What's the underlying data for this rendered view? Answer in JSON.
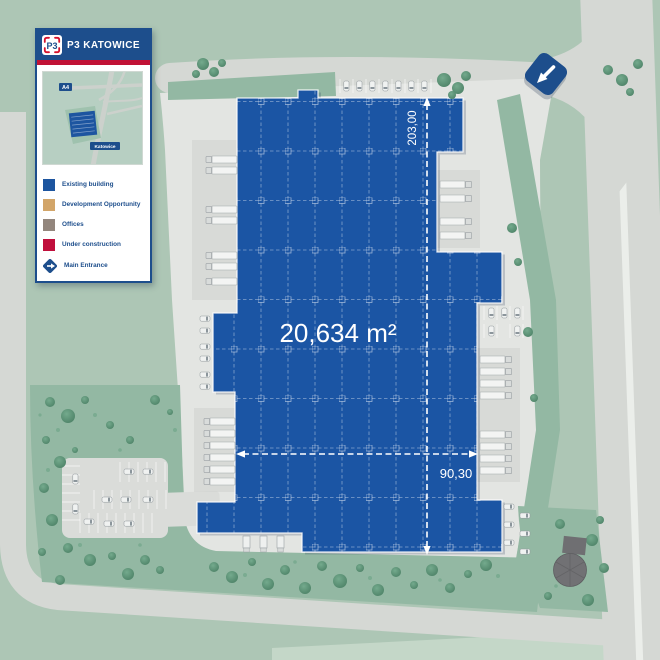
{
  "header": {
    "logo": "P3",
    "title": "P3 KATOWICE"
  },
  "inset_map": {
    "road_badge": "A4",
    "place_label": "Katowice"
  },
  "legend": {
    "items": [
      {
        "label": "Existing building",
        "color": "#1d559f"
      },
      {
        "label": "Development Opportunity",
        "color": "#d2a569"
      },
      {
        "label": "Offices",
        "color": "#93867d"
      },
      {
        "label": "Under construction",
        "color": "#c00f3c"
      },
      {
        "label": "Main Entrance",
        "color": "#1d4e8c"
      }
    ]
  },
  "building": {
    "name": "Existing building",
    "area": "20,634 m²",
    "length": "203,00",
    "width": "90,30"
  },
  "colors": {
    "building_blue": "#1b55a4",
    "header_blue": "#1d4e8c",
    "accent_red": "#c11236",
    "road_gray": "#d5d8d4",
    "pavement_gray": "#e3e5e2",
    "site_green": "#93b8a3",
    "background_green": "#adc6b5"
  }
}
